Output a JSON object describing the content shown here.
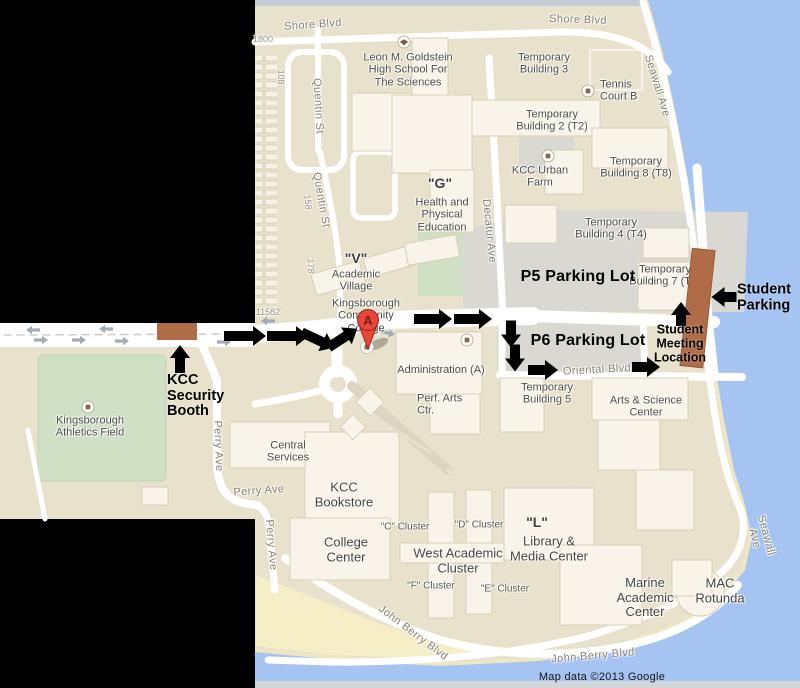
{
  "meta": {
    "app": "Google Maps campus map",
    "attribution": "Map data ©2013 Google"
  },
  "marker": {
    "letter": "A"
  },
  "colors": {
    "land": "#e8e2cc",
    "water": "#a6c4f2",
    "sand": "#f5eec6",
    "shoreline": "#efe7c3",
    "road": "#ffffff",
    "lot": "#d9d8d3",
    "field": "#cfe0c4",
    "bld": "#f8f4e9",
    "bldline": "#d8cfb5",
    "brown": "#b06c46",
    "traffic": "#a2adb9",
    "graystrip": "#c5cbd3",
    "graystrip2": "#d3d6da",
    "pin": "#e8463a",
    "pinline": "#99261c",
    "pinletter": "#7a1d12",
    "black": "#000000"
  },
  "labels": [
    {
      "t": "Shore Blvd",
      "x": 313,
      "y": 25,
      "rot": -4,
      "cls": "st",
      "name": "street-label-shore-blvd-west"
    },
    {
      "t": "Shore Blvd",
      "x": 578,
      "y": 20,
      "rot": 2,
      "cls": "st",
      "name": "street-label-shore-blvd-east"
    },
    {
      "t": "Seawall Ave",
      "x": 657,
      "y": 86,
      "rot": 73,
      "cls": "st",
      "name": "street-label-seawall-ave-north"
    },
    {
      "t": "Seawall Ave",
      "x": 760,
      "y": 537,
      "rot": 75,
      "cls": "st",
      "name": "street-label-seawall-ave-south"
    },
    {
      "t": "Quentin St",
      "x": 318,
      "y": 106,
      "rot": 87,
      "cls": "st",
      "name": "street-label-quentin-st-north"
    },
    {
      "t": "Quentin St",
      "x": 321,
      "y": 200,
      "rot": 80,
      "cls": "st",
      "name": "street-label-quentin-st-south"
    },
    {
      "t": "Decatur Ave",
      "x": 489,
      "y": 231,
      "rot": 84,
      "cls": "st",
      "name": "street-label-decatur-ave"
    },
    {
      "t": "Oriental Blvd",
      "x": 597,
      "y": 370,
      "rot": -3,
      "cls": "st",
      "name": "street-label-oriental-blvd"
    },
    {
      "t": "Perry Ave",
      "x": 218,
      "y": 446,
      "rot": 88,
      "cls": "st",
      "name": "street-label-perry-ave-vert1"
    },
    {
      "t": "Perry Ave",
      "x": 271,
      "y": 545,
      "rot": 85,
      "cls": "st",
      "name": "street-label-perry-ave-vert2"
    },
    {
      "t": "Perry Ave",
      "x": 259,
      "y": 491,
      "rot": -4,
      "cls": "st",
      "name": "street-label-perry-ave-horiz"
    },
    {
      "t": "John Berry Blvd",
      "x": 413,
      "y": 633,
      "rot": 37,
      "cls": "st",
      "name": "street-label-john-berry-blvd-diag"
    },
    {
      "t": "John Berry Blvd",
      "x": 593,
      "y": 656,
      "rot": -5,
      "cls": "st",
      "name": "street-label-john-berry-blvd-horiz"
    },
    {
      "t": "1800",
      "x": 263,
      "y": 39,
      "cls": "st-sm",
      "name": "address-label-1800"
    },
    {
      "t": "108",
      "x": 281,
      "y": 77,
      "rot": 90,
      "cls": "st-sm",
      "name": "address-label-108"
    },
    {
      "t": "158",
      "x": 308,
      "y": 202,
      "rot": 85,
      "cls": "st-sm",
      "name": "address-label-158"
    },
    {
      "t": "178",
      "x": 311,
      "y": 266,
      "rot": 87,
      "cls": "st-sm",
      "name": "address-label-178"
    },
    {
      "t": "11582",
      "x": 268,
      "y": 312,
      "cls": "st-sm",
      "name": "address-label-11582"
    },
    {
      "t": "Leon M. Goldstein\nHigh School For\nThe Sciences",
      "x": 408,
      "y": 70,
      "cls": "pl",
      "name": "poi-label-goldstein-hs"
    },
    {
      "t": "Temporary\nBuilding 3",
      "x": 544,
      "y": 64,
      "cls": "pl",
      "name": "poi-label-temp-bldg-3"
    },
    {
      "t": "Tennis\nCourt B",
      "x": 600,
      "y": 91,
      "anchor": "w",
      "cls": "pl",
      "name": "poi-label-tennis-court-b"
    },
    {
      "t": "Temporary\nBuilding 2 (T2)",
      "x": 552,
      "y": 121,
      "cls": "pl",
      "name": "poi-label-temp-bldg-2"
    },
    {
      "t": "KCC Urban\nFarm",
      "x": 540,
      "y": 177,
      "cls": "pl",
      "name": "poi-label-kcc-urban-farm"
    },
    {
      "t": "Temporary\nBuilding 8 (T8)",
      "x": 636,
      "y": 168,
      "cls": "pl",
      "name": "poi-label-temp-bldg-8"
    },
    {
      "t": "\"G\"",
      "x": 440,
      "y": 184,
      "cls": "pl-q",
      "name": "poi-label-g"
    },
    {
      "t": "Health and\nPhysical\nEducation",
      "x": 442,
      "y": 215,
      "cls": "pl",
      "name": "poi-label-health-physical-education"
    },
    {
      "t": "\"V\"",
      "x": 356,
      "y": 259,
      "cls": "pl-q",
      "name": "poi-label-v"
    },
    {
      "t": "Academic\nVillage",
      "x": 356,
      "y": 281,
      "cls": "pl",
      "name": "poi-label-academic-village"
    },
    {
      "t": "Temporary\nBuilding 4 (T4)",
      "x": 611,
      "y": 229,
      "cls": "pl",
      "name": "poi-label-temp-bldg-4"
    },
    {
      "t": "Temporary\nBuilding 7 (T7)",
      "x": 665,
      "y": 276,
      "cls": "pl",
      "name": "poi-label-temp-bldg-7"
    },
    {
      "t": "Kingsborough\nCommunity\nCollege",
      "x": 366,
      "y": 316,
      "cls": "pl",
      "name": "poi-label-kingsborough-cc"
    },
    {
      "t": "Administration (A)",
      "x": 441,
      "y": 370,
      "cls": "pl",
      "name": "poi-label-administration"
    },
    {
      "t": "Perf. Arts\nCtr.",
      "x": 417,
      "y": 405,
      "anchor": "w",
      "cls": "pl",
      "name": "poi-label-perf-arts-ctr"
    },
    {
      "t": "Temporary\nBuilding 5",
      "x": 547,
      "y": 394,
      "cls": "pl",
      "name": "poi-label-temp-bldg-5"
    },
    {
      "t": "Arts & Science\nCenter",
      "x": 646,
      "y": 407,
      "cls": "pl",
      "name": "poi-label-arts-science-center"
    },
    {
      "t": "Central\nServices",
      "x": 288,
      "y": 452,
      "cls": "pl",
      "name": "poi-label-central-services"
    },
    {
      "t": "Kingsborough\nAthletics Field",
      "x": 90,
      "y": 427,
      "cls": "pl",
      "name": "poi-label-athletics-field"
    },
    {
      "t": "KCC\nBookstore",
      "x": 344,
      "y": 495,
      "cls": "pl-lg",
      "name": "poi-label-kcc-bookstore"
    },
    {
      "t": "College\nCenter",
      "x": 346,
      "y": 550,
      "cls": "pl-lg",
      "name": "poi-label-college-center"
    },
    {
      "t": "West Academic\nCluster",
      "x": 458,
      "y": 561,
      "cls": "pl-lg",
      "name": "poi-label-west-academic-cluster"
    },
    {
      "t": "\"L\"",
      "x": 537,
      "y": 523,
      "cls": "pl-q",
      "name": "poi-label-l"
    },
    {
      "t": "Library &\nMedia Center",
      "x": 549,
      "y": 549,
      "cls": "pl-lg",
      "name": "poi-label-library-media-center"
    },
    {
      "t": "Marine\nAcademic\nCenter",
      "x": 645,
      "y": 598,
      "cls": "pl-lg",
      "name": "poi-label-marine-academic-center"
    },
    {
      "t": "MAC\nRotunda",
      "x": 720,
      "y": 591,
      "cls": "pl-lg",
      "name": "poi-label-mac-rotunda"
    },
    {
      "t": "\"C\" Cluster",
      "x": 405,
      "y": 527,
      "cls": "cl",
      "name": "poi-label-c-cluster"
    },
    {
      "t": "\"D\" Cluster",
      "x": 479,
      "y": 525,
      "cls": "cl",
      "name": "poi-label-d-cluster"
    },
    {
      "t": "\"F\" Cluster",
      "x": 431,
      "y": 586,
      "cls": "cl",
      "name": "poi-label-f-cluster"
    },
    {
      "t": "\"E\" Cluster",
      "x": 505,
      "y": 589,
      "cls": "cl",
      "name": "poi-label-e-cluster"
    },
    {
      "t": "Map data ©2013 Google",
      "x": 602,
      "y": 677,
      "cls": "attr",
      "name": "map-attribution"
    },
    {
      "t": "KCC\nSecurity\nBooth",
      "x": 167,
      "y": 396,
      "anchor": "w",
      "cls": "ann",
      "layer": "ann",
      "name": "annotation-kcc-security-booth"
    },
    {
      "t": "Student\nParking",
      "x": 737,
      "y": 298,
      "anchor": "w",
      "cls": "ann",
      "layer": "ann",
      "name": "annotation-student-parking"
    },
    {
      "t": "Student\nMeeting\nLocation",
      "x": 680,
      "y": 344,
      "cls": "ann-sm",
      "layer": "ann",
      "name": "annotation-student-meeting-location"
    },
    {
      "t": "P5 Parking Lot",
      "x": 578,
      "y": 277,
      "cls": "ann-lg",
      "layer": "ann",
      "name": "annotation-p5-parking-lot"
    },
    {
      "t": "P6 Parking Lot",
      "x": 588,
      "y": 341,
      "cls": "ann-lg",
      "layer": "ann",
      "name": "annotation-p6-parking-lot"
    }
  ],
  "arrows": [
    {
      "x": 245,
      "y": 336,
      "rot": 0,
      "len": 42
    },
    {
      "x": 288,
      "y": 336,
      "rot": 0,
      "len": 42
    },
    {
      "x": 318,
      "y": 340,
      "rot": 25,
      "len": 36
    },
    {
      "x": 343,
      "y": 338,
      "rot": -33,
      "len": 34
    },
    {
      "x": 433,
      "y": 319,
      "rot": 0,
      "len": 38
    },
    {
      "x": 473,
      "y": 319,
      "rot": 0,
      "len": 38
    },
    {
      "x": 511,
      "y": 334,
      "rot": 90,
      "len": 27
    },
    {
      "x": 515,
      "y": 358,
      "rot": 90,
      "len": 27
    },
    {
      "x": 543,
      "y": 370,
      "rot": 0,
      "len": 30
    },
    {
      "x": 646,
      "y": 367,
      "rot": 0,
      "len": 28
    },
    {
      "x": 681,
      "y": 314,
      "rot": -90,
      "len": 24
    },
    {
      "x": 724,
      "y": 297,
      "rot": 180,
      "len": 25
    },
    {
      "x": 180,
      "y": 359,
      "rot": -90,
      "len": 28
    }
  ],
  "traffic_arrows": [
    {
      "x": 33,
      "y": 330,
      "rot": 180
    },
    {
      "x": 106,
      "y": 329,
      "rot": 180
    },
    {
      "x": 41,
      "y": 340,
      "rot": 0
    },
    {
      "x": 79,
      "y": 340,
      "rot": 0
    },
    {
      "x": 122,
      "y": 341,
      "rot": 0
    },
    {
      "x": 224,
      "y": 342,
      "rot": 0
    },
    {
      "x": 268,
      "y": 321,
      "rot": 180
    },
    {
      "x": 388,
      "y": 333,
      "rot": 12
    }
  ],
  "poi_icons": [
    {
      "x": 88,
      "y": 407,
      "type": "dot",
      "name": "athletics-field-icon"
    },
    {
      "x": 588,
      "y": 91,
      "type": "dot",
      "name": "tennis-court-icon"
    },
    {
      "x": 548,
      "y": 156,
      "type": "dot",
      "name": "urban-farm-icon"
    },
    {
      "x": 467,
      "y": 340,
      "type": "dot",
      "name": "administration-icon"
    },
    {
      "x": 404,
      "y": 42,
      "type": "gradcap",
      "name": "school-icon"
    }
  ]
}
